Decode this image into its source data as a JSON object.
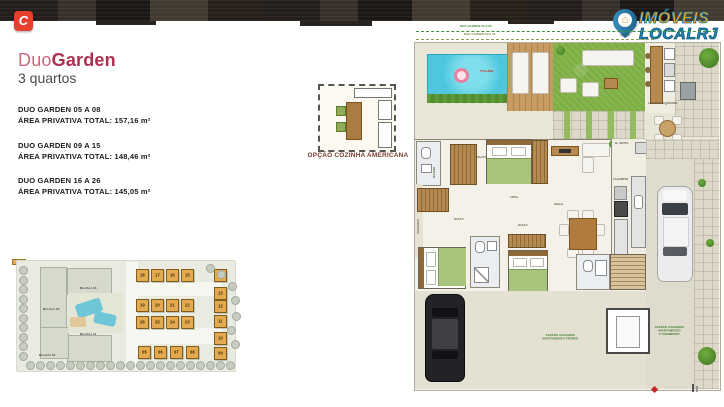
{
  "brand": {
    "calper_glyph": "C",
    "agency_line1": "IMÓVEIS",
    "agency_line2": "LOCALRJ",
    "pin_glyph": "⌂"
  },
  "panel": {
    "title_part1": "Duo",
    "title_part2": "Garden",
    "subtitle": "3 quartos",
    "units": [
      {
        "name": "DUO GARDEN 05 A 08",
        "area": "ÁREA PRIVATIVA TOTAL: 157,16 m²"
      },
      {
        "name": "DUO GARDEN 09 A 15",
        "area": "ÁREA PRIVATIVA TOTAL: 148,46 m²"
      },
      {
        "name": "DUO GARDEN 16 A 26",
        "area": "ÁREA PRIVATIVA TOTAL: 145,05 m²"
      }
    ]
  },
  "inset": {
    "label": "OPÇÃO COZINHA AMERICANA"
  },
  "site_plan": {
    "blocks": [
      "BLOCO 03",
      "BLOCO 04",
      "BLOCO 01",
      "BLOCO 02"
    ],
    "unit_rows": [
      [
        "18",
        "17",
        "16",
        "15"
      ],
      [
        "19",
        "20",
        "21",
        "22"
      ],
      [
        "26",
        "25",
        "24",
        "23"
      ],
      [
        "05",
        "06",
        "07",
        "08"
      ]
    ],
    "right_column": [
      "14",
      "13",
      "12",
      "11",
      "10",
      "09"
    ]
  },
  "floor_plan": {
    "annotation1": "DUO GARDEN 05 A 08",
    "annotation2": "DUO GARDEN 09 A 15",
    "labels": {
      "piscina": "PISCINA",
      "churrasqueira": "CHURRASQUEIRA",
      "suite": "SUITE",
      "banho": "BANHO",
      "circ": "CIRC.",
      "sala": "SALA",
      "cozinha": "COZINHA",
      "aserv": "A. SERV.",
      "varanda": "VARANDA",
      "acesso_terreo": [
        "ACESSO GARAGEM",
        "APARTAMENTO TÉRREO"
      ],
      "acesso_sup": [
        "ACESSO GARAGEM",
        "APARTAMENTO",
        "2º PAVIMENTO"
      ]
    }
  },
  "colors": {
    "brand_red": "#e8402f",
    "logo_orange": "#f7a71b",
    "logo_blue": "#2187b5",
    "title_pink": "#c96a7c",
    "title_magenta": "#ad2f52",
    "site_unit": "#e3aa4f",
    "lawn": "#85b54b",
    "pool": "#4ec7de"
  }
}
